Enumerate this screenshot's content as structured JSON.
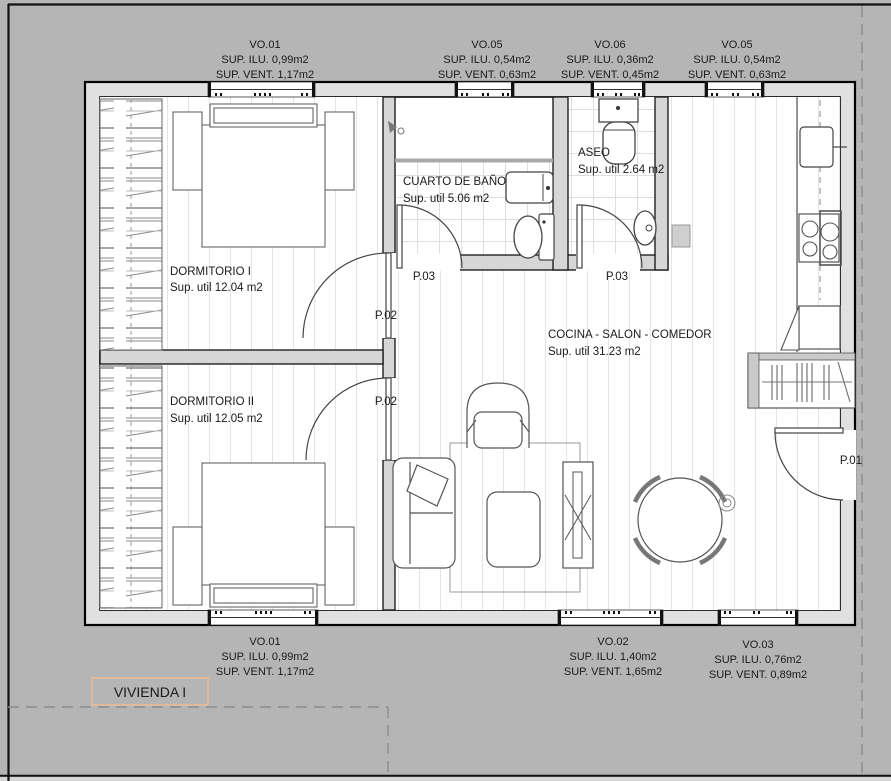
{
  "title": {
    "label": "VIVIENDA I"
  },
  "rooms": {
    "dorm1": {
      "name": "DORMITORIO I",
      "area": "Sup. util  12.04 m2"
    },
    "dorm2": {
      "name": "DORMITORIO II",
      "area": "Sup. util  12.05 m2"
    },
    "bath": {
      "name": "CUARTO DE BAÑO",
      "area": "Sup. util  5.06 m2"
    },
    "aseo": {
      "name": "ASEO",
      "area": "Sup. util  2.64 m2"
    },
    "living": {
      "name": "COCINA - SALON - COMEDOR",
      "area": "Sup. util  31.23 m2"
    }
  },
  "doors": {
    "p01": "P.01",
    "p02": "P.02",
    "p03": "P.03"
  },
  "windows_top": [
    {
      "code": "VO.01",
      "ilu": "SUP. ILU. 0,99m2",
      "vent": "SUP. VENT. 1,17m2"
    },
    {
      "code": "VO.05",
      "ilu": "SUP. ILU. 0,54m2",
      "vent": "SUP. VENT. 0,63m2"
    },
    {
      "code": "VO.06",
      "ilu": "SUP. ILU. 0,36m2",
      "vent": "SUP. VENT. 0,45m2"
    },
    {
      "code": "VO.05",
      "ilu": "SUP. ILU. 0,54m2",
      "vent": "SUP. VENT. 0,63m2"
    }
  ],
  "windows_bottom": [
    {
      "code": "VO.01",
      "ilu": "SUP. ILU. 0,99m2",
      "vent": "SUP. VENT. 1,17m2"
    },
    {
      "code": "VO.02",
      "ilu": "SUP. ILU. 1,40m2",
      "vent": "SUP. VENT. 1,65m2"
    },
    {
      "code": "VO.03",
      "ilu": "SUP. ILU. 0,76m2",
      "vent": "SUP. VENT. 0,89m2"
    }
  ],
  "colors": {
    "background": "#b5b5b5",
    "wall_fill": "#e0e0e0",
    "interior_wall_fill": "#d6d6d6",
    "title_box_border": "#f2b98e",
    "entrance_label": "#8c5a28"
  }
}
